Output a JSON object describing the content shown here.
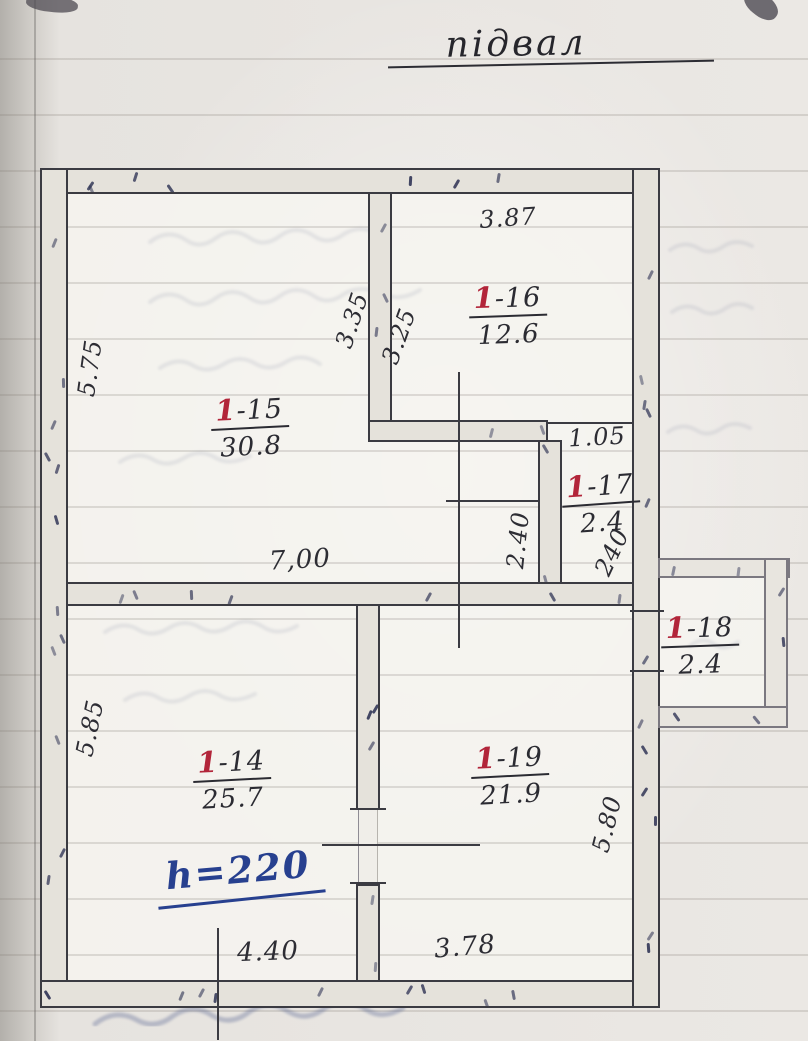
{
  "page": {
    "title": "підвал"
  },
  "plan": {
    "rooms": [
      {
        "number_red": "1",
        "number_rest": "-15",
        "area": "30.8"
      },
      {
        "number_red": "1",
        "number_rest": "-16",
        "area": "12.6"
      },
      {
        "number_red": "1",
        "number_rest": "-17",
        "area": "2.4"
      },
      {
        "number_red": "1",
        "number_rest": "-18",
        "area": "2.4"
      },
      {
        "number_red": "1",
        "number_rest": "-14",
        "area": "25.7"
      },
      {
        "number_red": "1",
        "number_rest": "-19",
        "area": "21.9"
      }
    ],
    "dimensions": [
      {
        "value": "5.75"
      },
      {
        "value": "5.85"
      },
      {
        "value": "3.87"
      },
      {
        "value": "3.35"
      },
      {
        "value": "3.25"
      },
      {
        "value": "1.05"
      },
      {
        "value": "2.40"
      },
      {
        "value": "240"
      },
      {
        "value": "7,00"
      },
      {
        "value": "5.80"
      },
      {
        "value": "4.40"
      },
      {
        "value": "3.78"
      }
    ],
    "height_note": "h=220",
    "ink_colors": {
      "black": "#2c2c33",
      "red": "#b2253a",
      "blue": "#27408f"
    }
  }
}
